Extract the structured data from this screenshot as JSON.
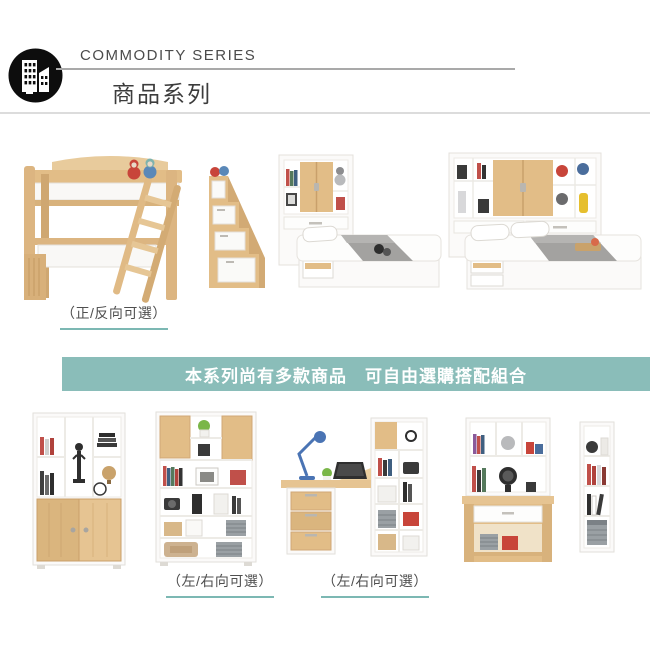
{
  "header": {
    "series_en": "COMMODITY SERIES",
    "series_zh": "商品系列",
    "logo_icon": "buildings-icon"
  },
  "banner": {
    "text": "本系列尚有多款商品　可自由選購搭配組合"
  },
  "products": {
    "top_row": [
      {
        "name": "loft-bed-with-ladder",
        "note": "（正/反向可選）"
      },
      {
        "name": "stair-storage-cabinet"
      },
      {
        "name": "single-bed-with-storage-headboard"
      },
      {
        "name": "double-bed-with-storage-headboard"
      }
    ],
    "bottom_row": [
      {
        "name": "sliding-door-bookcase"
      },
      {
        "name": "open-shelf-bookcase",
        "note": "（左/右向可選）"
      },
      {
        "name": "corner-desk-with-bookcase",
        "note": "（左/右向可選）"
      },
      {
        "name": "desk-with-hutch"
      },
      {
        "name": "narrow-bookcase"
      }
    ]
  },
  "colors": {
    "banner_bg": "#8abdb9",
    "note_underline": "#7cb8b3",
    "wood": "#e2bd87",
    "header_rule": "#a9a9a9"
  }
}
